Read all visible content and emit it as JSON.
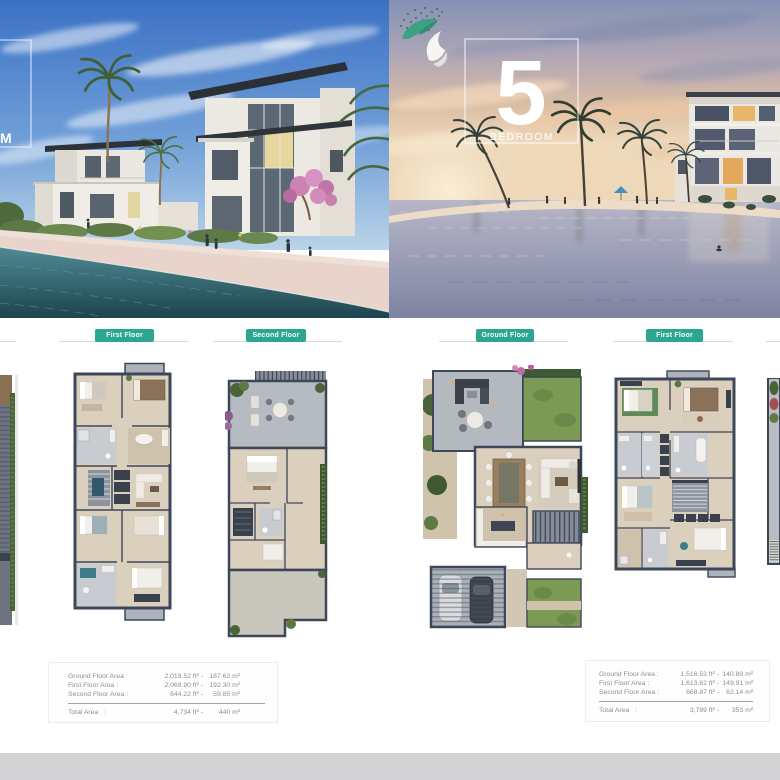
{
  "hero": {
    "left": {
      "bedroom_fragment": "M"
    },
    "right": {
      "number": "5",
      "label": "BEDROOM"
    }
  },
  "floor_labels": {
    "plan1": "First Floor",
    "plan2": "Second Floor",
    "plan3": "Ground Floor",
    "plan4": "First Floor"
  },
  "area_tables": {
    "left": {
      "rows": [
        {
          "label": "Ground Floor Area :",
          "ft": "2,019.52 ft² -",
          "m": "187.62 m²"
        },
        {
          "label": "First Floor Area :",
          "ft": "2,069.90 ft² -",
          "m": "192.30 m²"
        },
        {
          "label": "Second Floor Area :",
          "ft": "644.22 ft² -",
          "m": "59.85 m²"
        }
      ],
      "total": {
        "label": "Total Area   :",
        "ft": "4,734 ft² -",
        "m": "440 m²"
      }
    },
    "right": {
      "rows": [
        {
          "label": "Ground Floor Area :",
          "ft": "1,516.53 ft² -",
          "m": "140.89 m²"
        },
        {
          "label": "First Floor Area :",
          "ft": "1,613.62 ft² -",
          "m": "149.91 m²"
        },
        {
          "label": "Second Floor Area :",
          "ft": "668.87 ft² -",
          "m": "62.14 m²"
        }
      ],
      "total": {
        "label": "Total Area   :",
        "ft": "3,799 ft² -",
        "m": "353 m²"
      }
    }
  },
  "colors": {
    "accent_green": "#2aa78e",
    "rule_gray": "#d6dcda",
    "footer_strip": "#d2d2d4"
  }
}
